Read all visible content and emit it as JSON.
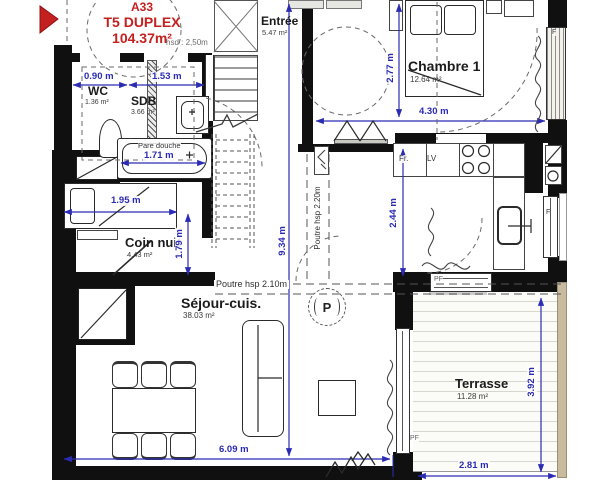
{
  "title_block": {
    "unit_id": "A33",
    "unit_type": "T5 DUPLEX",
    "unit_area": "104.37m²",
    "height_note": "hsd : 2,50m"
  },
  "rooms": {
    "entree": {
      "name": "Entrée",
      "area": "5.47 m²"
    },
    "chambre1": {
      "name": "Chambre 1",
      "area": "12.64 m²"
    },
    "wc": {
      "name": "WC",
      "area": "1.36 m²"
    },
    "sdb": {
      "name": "SDB",
      "area": "3.66 m²"
    },
    "coin_nuit": {
      "name": "Coin nuit",
      "area": "4.43 m²"
    },
    "sejour": {
      "name": "Séjour-cuis.",
      "area": "38.03 m²"
    },
    "terrasse": {
      "name": "Terrasse",
      "area": "11.28 m²"
    }
  },
  "dimensions": {
    "wc_width": "0.90 m",
    "sdb_width": "1.53 m",
    "bath_length": "1.71 m",
    "coin_nuit_width": "1.95 m",
    "coin_nuit_depth": "1.79 m",
    "plan_depth": "9.34 m",
    "chambre_depth": "2.77 m",
    "chambre_width": "4.30 m",
    "kitchen_depth": "2.44 m",
    "sejour_width": "6.09 m",
    "terrasse_width": "2.81 m",
    "terrasse_depth": "3.92 m"
  },
  "beams": {
    "beam_210": "Poutre hsp 2.10m",
    "beam_220": "Poutre hsp 2.20m"
  },
  "labels": {
    "shower_screen": "Pare douche",
    "fridge": "Fr.",
    "dishwasher": "LV",
    "parking": "P",
    "window": "F",
    "french_window": "PF"
  },
  "colors": {
    "accent_red": "#c4201f",
    "dimension_blue": "#2b2bb4",
    "wall_black": "#101010",
    "terrace_edge_beige": "#c9bb9e"
  }
}
